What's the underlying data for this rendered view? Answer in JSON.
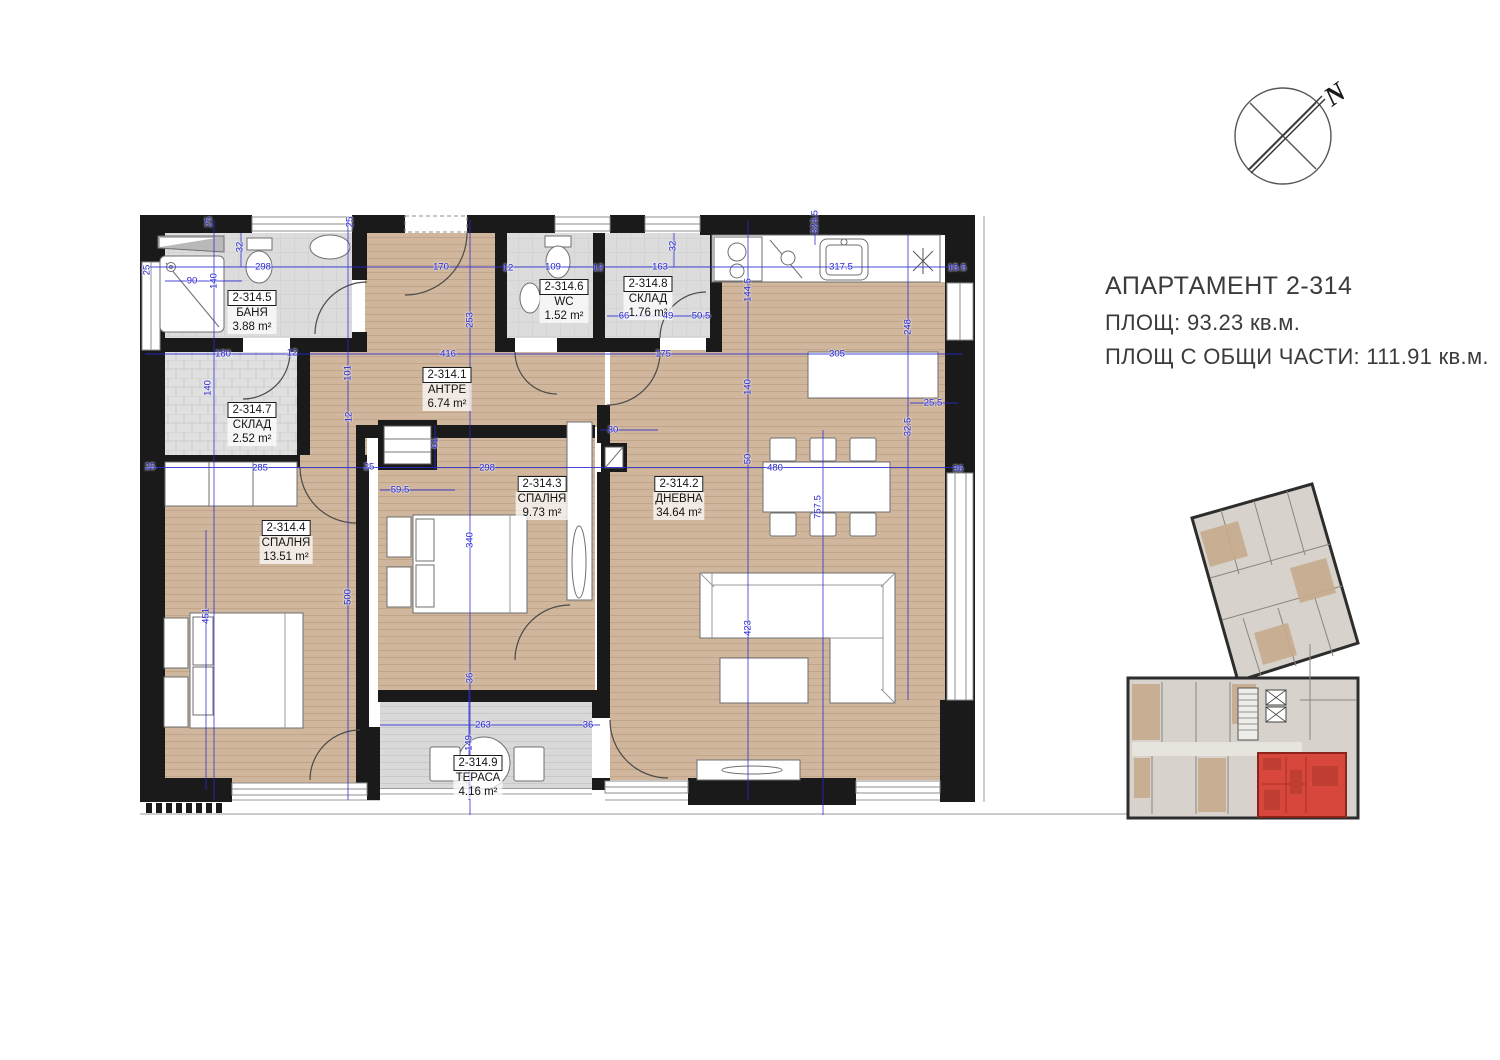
{
  "title_block": {
    "apartment_title": "АПАРТАМЕНТ  2-314",
    "area_line": "ПЛОЩ: 93.23 кв.м.",
    "common_area_line": "ПЛОЩ С ОБЩИ ЧАСТИ: 111.91 кв.м."
  },
  "compass": {
    "north_label": "N"
  },
  "colors": {
    "wall": "#1a1a1a",
    "wood_floor": "#cfb69c",
    "tile_floor": "#dcdcdc",
    "dimension_blue": "#2424cf",
    "highlight_red": "#d7473b"
  },
  "plan": {
    "rooms": [
      {
        "id": "2-314.1",
        "name": "АНТРЕ",
        "area": "6.74 m²",
        "x": 447,
        "y": 367
      },
      {
        "id": "2-314.2",
        "name": "ДНЕВНА",
        "area": "34.64 m²",
        "x": 679,
        "y": 476
      },
      {
        "id": "2-314.3",
        "name": "СПАЛНЯ",
        "area": "9.73 m²",
        "x": 542,
        "y": 476
      },
      {
        "id": "2-314.4",
        "name": "СПАЛНЯ",
        "area": "13.51 m²",
        "x": 286,
        "y": 520
      },
      {
        "id": "2-314.5",
        "name": "БАНЯ",
        "area": "3.88 m²",
        "x": 252,
        "y": 290
      },
      {
        "id": "2-314.6",
        "name": "WC",
        "area": "1.52 m²",
        "x": 564,
        "y": 279
      },
      {
        "id": "2-314.7",
        "name": "СКЛАД",
        "area": "2.52 m²",
        "x": 252,
        "y": 402
      },
      {
        "id": "2-314.8",
        "name": "СКЛАД",
        "area": "1.76 m²",
        "x": 648,
        "y": 276
      },
      {
        "id": "2-314.9",
        "name": "ТЕРАСА",
        "area": "4.16 m²",
        "x": 478,
        "y": 755
      }
    ],
    "dims_h": [
      {
        "t": "298",
        "x": 263,
        "y": 267
      },
      {
        "t": "90",
        "x": 192,
        "y": 281
      },
      {
        "t": "170",
        "x": 441,
        "y": 267
      },
      {
        "t": "12",
        "x": 508,
        "y": 268
      },
      {
        "t": "109",
        "x": 553,
        "y": 267
      },
      {
        "t": "12",
        "x": 598,
        "y": 268
      },
      {
        "t": "163",
        "x": 660,
        "y": 267
      },
      {
        "t": "317.5",
        "x": 841,
        "y": 267
      },
      {
        "t": "15.5",
        "x": 957,
        "y": 268
      },
      {
        "t": "66",
        "x": 624,
        "y": 316
      },
      {
        "t": "49",
        "x": 668,
        "y": 316
      },
      {
        "t": "50.5",
        "x": 701,
        "y": 316
      },
      {
        "t": "180",
        "x": 223,
        "y": 354
      },
      {
        "t": "12",
        "x": 292,
        "y": 353
      },
      {
        "t": "416",
        "x": 448,
        "y": 354
      },
      {
        "t": "175",
        "x": 663,
        "y": 354
      },
      {
        "t": "305",
        "x": 837,
        "y": 354
      },
      {
        "t": "285",
        "x": 260,
        "y": 468
      },
      {
        "t": "25",
        "x": 150,
        "y": 467
      },
      {
        "t": "25",
        "x": 369,
        "y": 467
      },
      {
        "t": "298",
        "x": 487,
        "y": 468
      },
      {
        "t": "59.5",
        "x": 400,
        "y": 490
      },
      {
        "t": "480",
        "x": 775,
        "y": 468
      },
      {
        "t": "36",
        "x": 958,
        "y": 469
      },
      {
        "t": "25.5",
        "x": 933,
        "y": 403
      },
      {
        "t": "30",
        "x": 613,
        "y": 430
      },
      {
        "t": "263",
        "x": 483,
        "y": 725
      },
      {
        "t": "36",
        "x": 588,
        "y": 725
      }
    ],
    "dims_v": [
      {
        "t": "25",
        "x": 147,
        "y": 270
      },
      {
        "t": "25",
        "x": 209,
        "y": 222
      },
      {
        "t": "25",
        "x": 350,
        "y": 222
      },
      {
        "t": "323.5",
        "x": 815,
        "y": 222
      },
      {
        "t": "32",
        "x": 240,
        "y": 247
      },
      {
        "t": "140",
        "x": 214,
        "y": 281
      },
      {
        "t": "32",
        "x": 673,
        "y": 246
      },
      {
        "t": "144.5",
        "x": 748,
        "y": 290
      },
      {
        "t": "248",
        "x": 908,
        "y": 327
      },
      {
        "t": "253",
        "x": 470,
        "y": 320
      },
      {
        "t": "101",
        "x": 348,
        "y": 373
      },
      {
        "t": "140",
        "x": 208,
        "y": 388
      },
      {
        "t": "140",
        "x": 748,
        "y": 387
      },
      {
        "t": "12",
        "x": 349,
        "y": 417
      },
      {
        "t": "61",
        "x": 435,
        "y": 443
      },
      {
        "t": "340",
        "x": 470,
        "y": 540
      },
      {
        "t": "500",
        "x": 348,
        "y": 597
      },
      {
        "t": "451",
        "x": 206,
        "y": 616
      },
      {
        "t": "757.5",
        "x": 818,
        "y": 507
      },
      {
        "t": "50",
        "x": 748,
        "y": 459
      },
      {
        "t": "423",
        "x": 748,
        "y": 628
      },
      {
        "t": "32.5",
        "x": 908,
        "y": 427
      },
      {
        "t": "36",
        "x": 470,
        "y": 678
      },
      {
        "t": "149",
        "x": 469,
        "y": 743
      }
    ]
  }
}
